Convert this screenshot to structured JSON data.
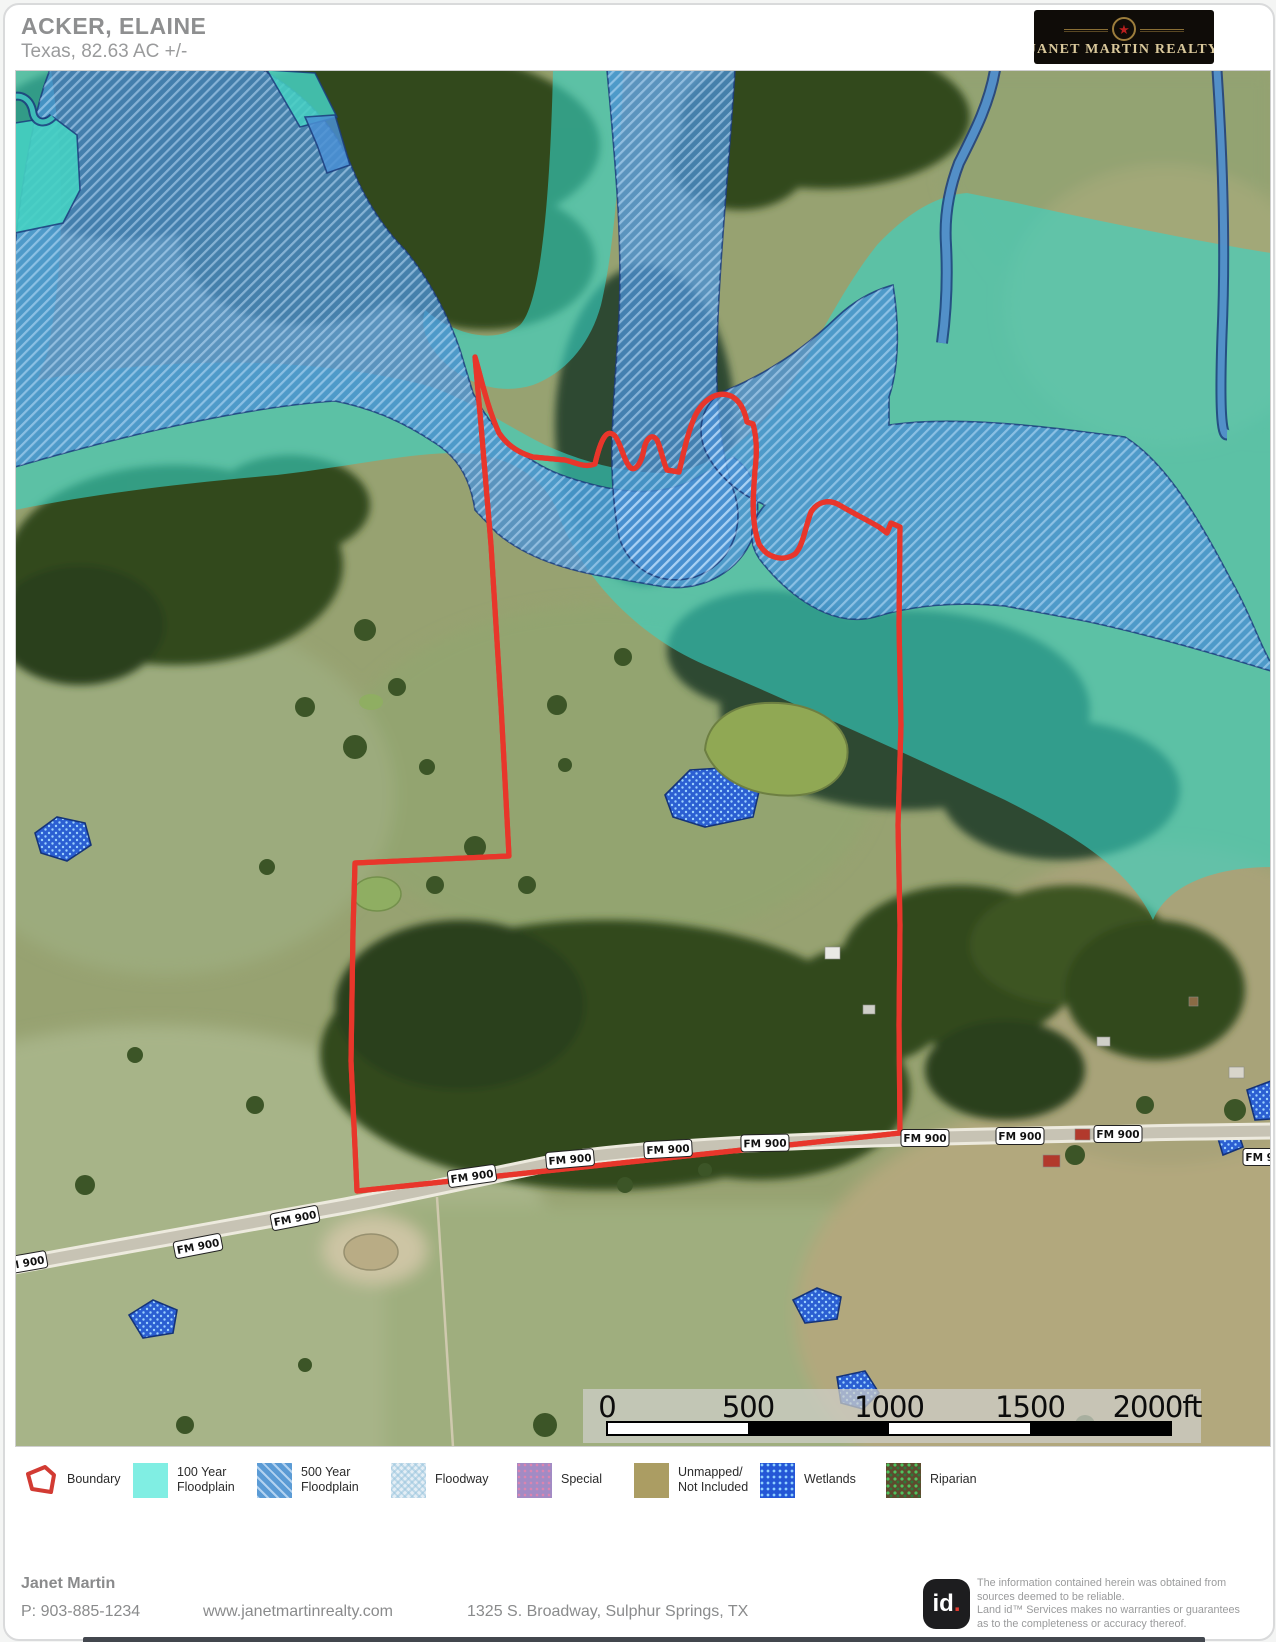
{
  "header": {
    "title": "ACKER, ELAINE",
    "subtitle": "Texas, 82.63 AC +/-",
    "logo": {
      "name": "JANET MARTIN REALTY",
      "star": "★"
    }
  },
  "map": {
    "road_label": "FM 900",
    "scale": {
      "t0": "0",
      "t1": "500",
      "t2": "1000",
      "t3": "1500",
      "t4": "2000ft"
    }
  },
  "legend": {
    "items": [
      {
        "label": "Boundary"
      },
      {
        "line1": "100 Year",
        "line2": "Floodplain"
      },
      {
        "line1": "500 Year",
        "line2": "Floodplain"
      },
      {
        "label": "Floodway"
      },
      {
        "label": "Special"
      },
      {
        "line1": "Unmapped/",
        "line2": "Not Included"
      },
      {
        "label": "Wetlands"
      },
      {
        "label": "Riparian"
      }
    ]
  },
  "footer": {
    "agent": "Janet Martin",
    "phone": "P: 903-885-1234",
    "website": "www.janetmartinrealty.com",
    "address": "1325 S. Broadway, Sulphur Springs, TX",
    "logo_text": "id",
    "logo_dot": ".",
    "disclaimer": {
      "l1": "The information contained herein was obtained from",
      "l2": "sources deemed to be reliable.",
      "l3": "Land id™ Services makes no warranties or guarantees",
      "l4": "as to the completeness or accuracy thereof."
    }
  },
  "colors": {
    "boundary_red": "#e8362b",
    "floodplain_100yr": "#80eee3",
    "floodplain_500yr": "#5b9bd5",
    "floodway": "#e4eef5",
    "special": "#a28bc4",
    "unmapped": "#ab9d63",
    "wetlands": "#2457d6",
    "riparian": "#3f6d33"
  }
}
